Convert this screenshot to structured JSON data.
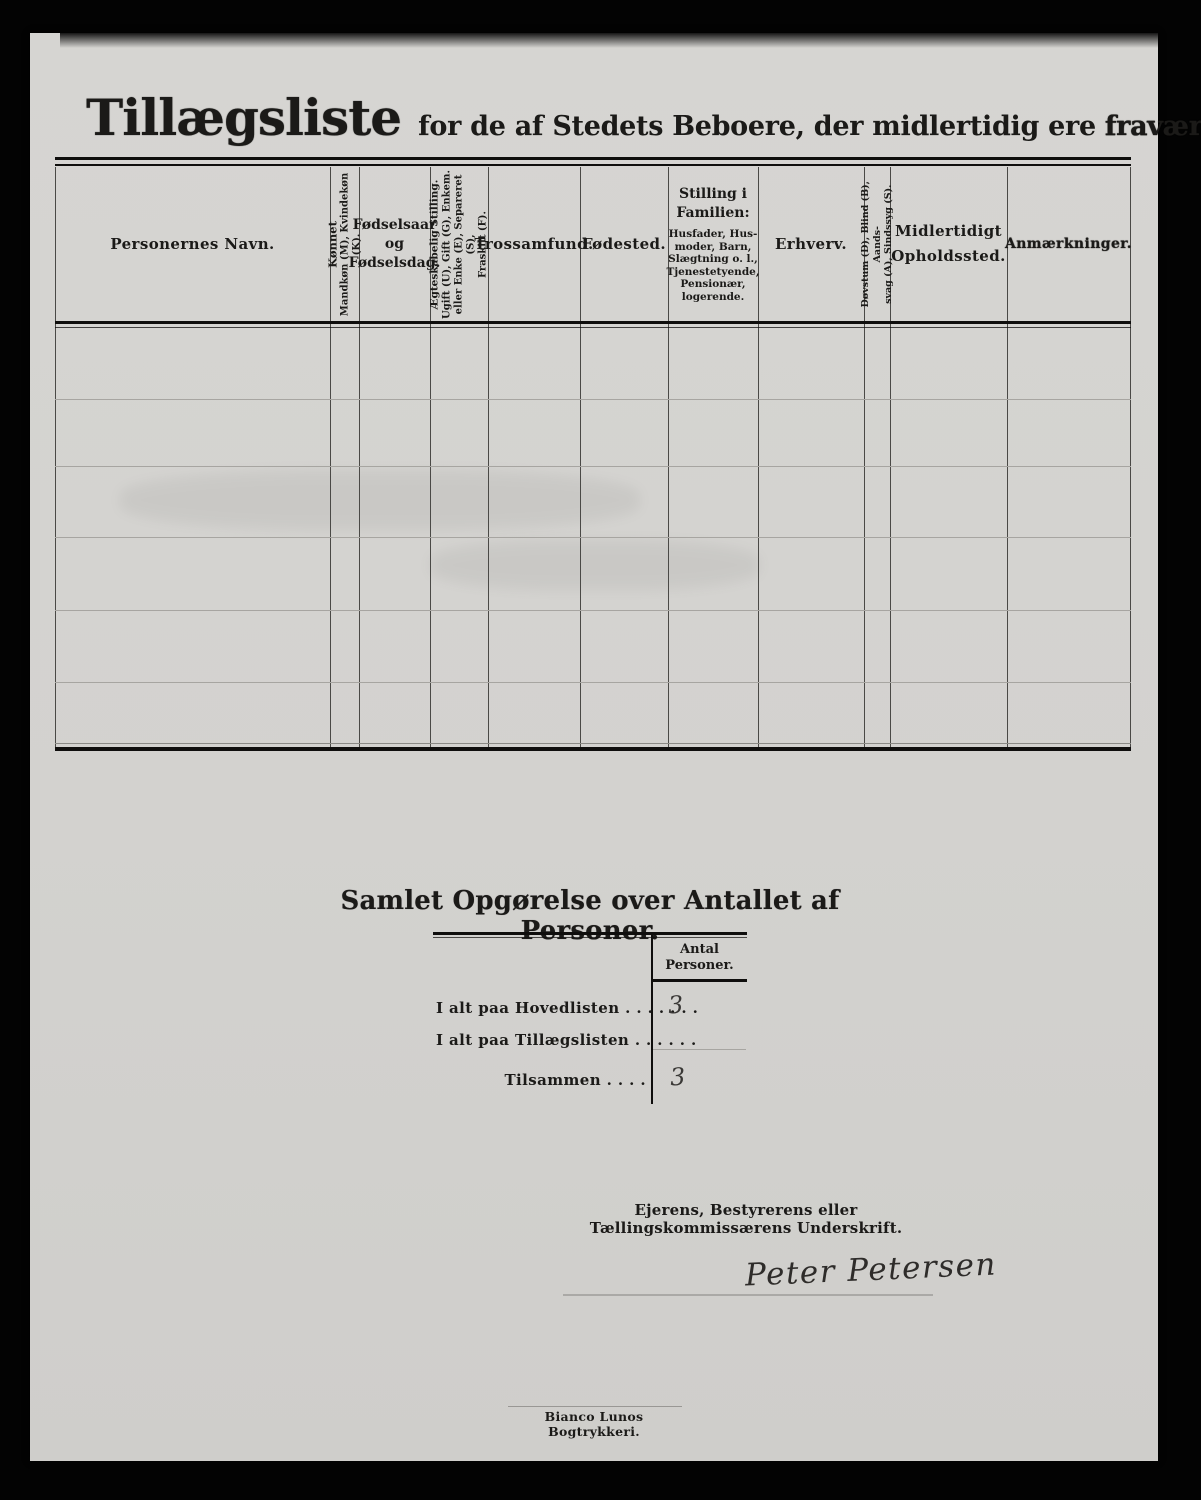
{
  "page": {
    "title": "Tillægsliste",
    "subtitle": "for de af Stedets Beboere, der midlertidig ere",
    "subtitle_emphasis": "fraværende."
  },
  "colors": {
    "background": "#030303",
    "paper": "#d3d2cf",
    "ink": "#1b1a18",
    "faint_line": "#a7a5a1"
  },
  "table": {
    "columns": [
      {
        "id": "personernes-navn",
        "lines": [
          "Personernes Navn."
        ]
      },
      {
        "id": "konnet",
        "vertical": true,
        "lines": [
          "Kønnet",
          "Mandkøn (M), Kvindekøn (K)."
        ]
      },
      {
        "id": "fodselsaar",
        "lines": [
          "Fødselsaar",
          "og",
          "Fødselsdag."
        ]
      },
      {
        "id": "aegteskabelig-stilling",
        "vertical": true,
        "lines": [
          "Ægteskabelig Stilling.",
          "Ugift (U), Gift (G), Enkem.",
          "eller Enke (E), Separeret (S),",
          "Fraskilt (F)."
        ]
      },
      {
        "id": "trossamfund",
        "lines": [
          "Trossamfund."
        ]
      },
      {
        "id": "fodested",
        "lines": [
          "Fødested."
        ]
      },
      {
        "id": "stilling-i-familien",
        "lines": [
          "Stilling i",
          "Familien:"
        ],
        "sublines": [
          "Husfader, Hus-",
          "moder, Barn,",
          "Slægtning o. l.,",
          "Tjenestetyende,",
          "Pensionær,",
          "logerende."
        ]
      },
      {
        "id": "erhverv",
        "lines": [
          "Erhverv."
        ]
      },
      {
        "id": "dovstum",
        "vertical": true,
        "lines": [
          "Døvstum (D), Blind (B), Aands-",
          "svag (A), Sindssyg (S)."
        ]
      },
      {
        "id": "midlertidigt-opholdssted",
        "lines": [
          "Midlertidigt",
          "Opholdssted."
        ]
      },
      {
        "id": "anmaerkninger",
        "lines": [
          "Anmærkninger."
        ]
      }
    ],
    "empty_row_count": 6
  },
  "summary": {
    "heading": "Samlet Opgørelse over Antallet af Personer.",
    "value_column_header": [
      "Antal",
      "Personer."
    ],
    "rows": [
      {
        "label": "I alt paa Hovedlisten . . . . . . .",
        "value": "3"
      },
      {
        "label": "I alt paa Tillægslisten  . . . . . .",
        "value": ""
      },
      {
        "label": "Tilsammen . . . .",
        "value": "3"
      }
    ]
  },
  "signature": {
    "caption": "Ejerens, Bestyrerens eller Tællingskommissærens Underskrift.",
    "name": "Peter Petersen"
  },
  "footer": {
    "printer": "Bianco Lunos Bogtrykkeri."
  }
}
